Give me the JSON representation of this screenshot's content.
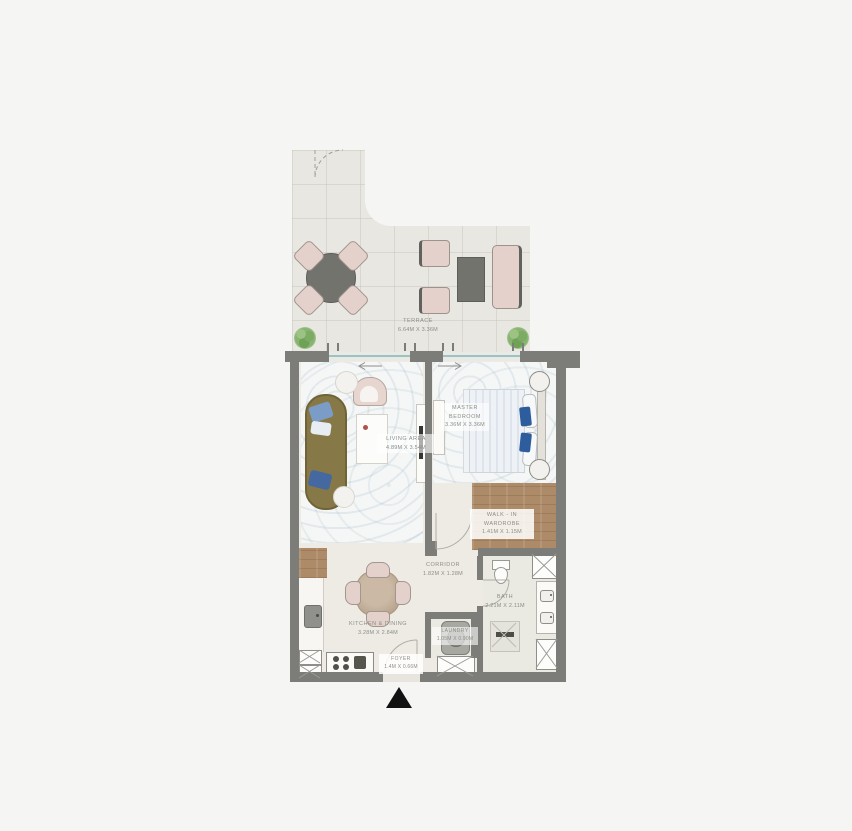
{
  "page": {
    "background": "#f5f5f3",
    "type": "apartment-floor-plan"
  },
  "rooms": {
    "terrace": {
      "name": "TERRACE",
      "dims": "6.64M X 3.36M"
    },
    "living_area": {
      "name": "LIVING AREA",
      "dims": "4.89m X 3.54m"
    },
    "master_bedroom": {
      "name": "MASTER BEDROOM",
      "dims": "3.36m X 3.36m"
    },
    "walk_in_wardrobe": {
      "name": "WALK - IN WARDROBE",
      "dims": "1.41m X 1.15m"
    },
    "corridor": {
      "name": "CORRIDOR",
      "dims": "1.82m X 1.28m"
    },
    "kitchen_dining": {
      "name": "KITCHEN & DINING",
      "dims": "3.28M X 2.84M"
    },
    "bath": {
      "name": "BATH",
      "dims": "2.21m X 2.11m"
    },
    "laundry": {
      "name": "LAUNDRY",
      "dims": "1.05m X 0.90m"
    },
    "foyer": {
      "name": "FOYER",
      "dims": "1.4m X 0.66m"
    }
  },
  "icons": {
    "entry_arrow": "entry-direction-triangle",
    "tree": "terrace-plant",
    "door_swing": "door-swing-arc",
    "shaft": "duct-shaft-x-box"
  },
  "colors": {
    "wall": "#7c7c79",
    "terrace_floor": "#e8e7e1",
    "interior_floor": "#edebe4",
    "wood_floor": "#ad8b68",
    "furniture_pink": "#e4d1cb",
    "sofa_olive": "#867947",
    "bed_accent_blue": "#2e5d9d",
    "window_glass": "#9cc2c1",
    "tree_green": "#88b471",
    "entry_marker": "#121212"
  }
}
